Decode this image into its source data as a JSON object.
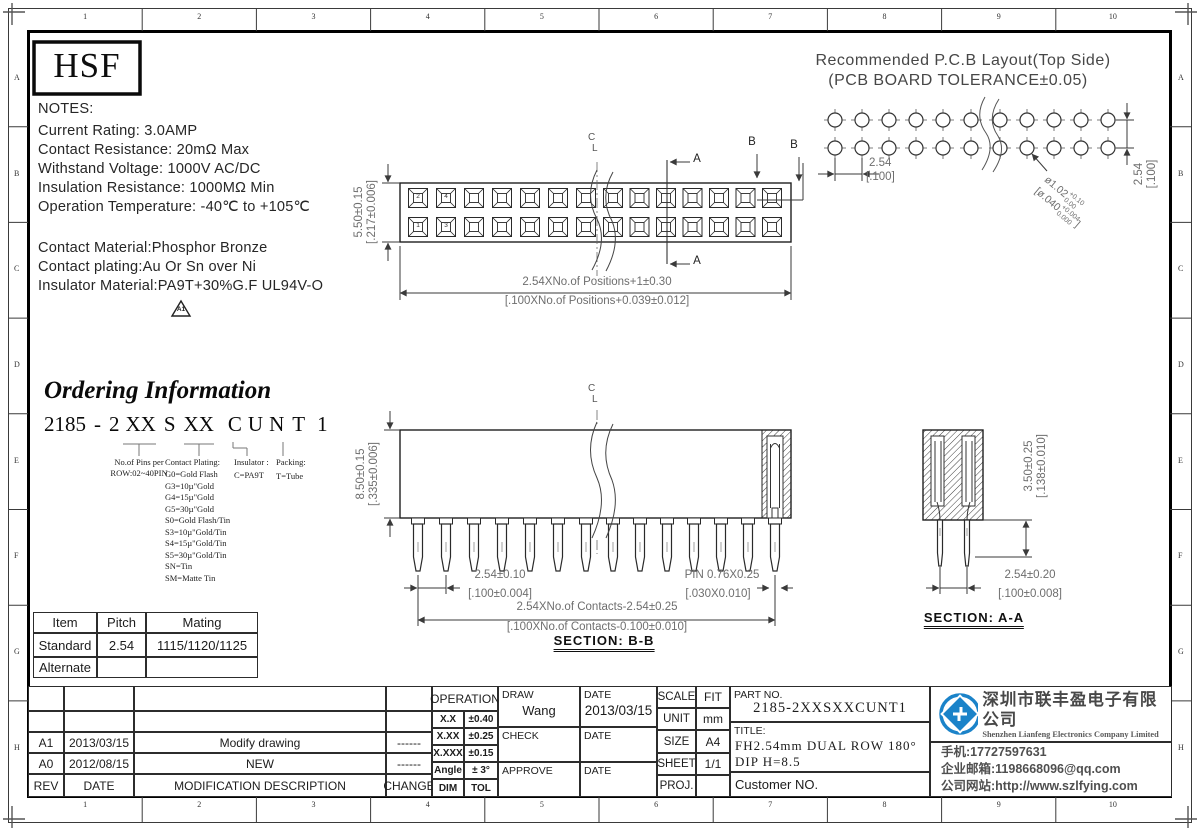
{
  "logo_text": "HSF",
  "zones": {
    "cols": [
      "1",
      "2",
      "3",
      "4",
      "5",
      "6",
      "7",
      "8",
      "9",
      "10"
    ],
    "rows": [
      "A",
      "B",
      "C",
      "D",
      "E",
      "F",
      "G",
      "H"
    ]
  },
  "notes": {
    "heading": "NOTES:",
    "lines": [
      "Current Rating: 3.0AMP",
      "Contact Resistance: 20mΩ Max",
      "Withstand Voltage: 1000V AC/DC",
      "Insulation Resistance: 1000MΩ Min",
      "Operation Temperature: -40℃ to +105℃"
    ],
    "material_lines": [
      "Contact Material:Phosphor Bronze",
      "Contact plating:Au Or Sn over Ni",
      "Insulator Material:PA9T+30%G.F UL94V-O"
    ],
    "rev_triangle": "A1"
  },
  "pcb_layout": {
    "title": "Recommended P.C.B Layout(Top Side)",
    "subtitle": "(PCB BOARD TOLERANCE±0.05)",
    "pitch": [
      "2.54",
      "[.100]"
    ],
    "row_pitch": [
      "2.54",
      "[.100]"
    ],
    "hole_mm": {
      "main": "ø1.02",
      "plus": "+0.10",
      "minus": "0.00"
    },
    "hole_in": {
      "main": "[ø.040",
      "plus": "+0.004",
      "minus": "0.000",
      "close": "]"
    }
  },
  "top_view": {
    "height_dim": [
      "5.50±0.15",
      "[.217±0.006]"
    ],
    "length_dim": [
      "2.54XNo.of Positions+1±0.30",
      "[.100XNo.of Positions+0.039±0.012]"
    ],
    "pin_labels": [
      "2",
      "4",
      "1",
      "3"
    ],
    "centerline": [
      "C",
      "L"
    ],
    "section_a": "A",
    "section_b": "B"
  },
  "section_bb": {
    "label": "SECTION: B-B",
    "centerline": [
      "C",
      "L"
    ],
    "height_dim": [
      "8.50±0.15",
      "[.335±0.006]"
    ],
    "pitch_dim": [
      "2.54±0.10",
      "[.100±0.004]"
    ],
    "pin_dim": [
      "PIN 0.76X0.25",
      "[.030X0.010]"
    ],
    "span_dim": [
      "2.54XNo.of Contacts-2.54±0.25",
      "[.100XNo.of Contacts-0.100±0.010]"
    ]
  },
  "section_aa": {
    "label": "SECTION: A-A",
    "tail_dim": [
      "3.50±0.25",
      "[.138±0.010]"
    ],
    "row_dim": [
      "2.54±0.20",
      "[.100±0.008]"
    ]
  },
  "ordering": {
    "title": "Ordering Information",
    "code_parts": [
      "2185",
      "-",
      "2",
      "XX",
      "S",
      "XX",
      "C",
      "U",
      "N",
      "T",
      "1"
    ],
    "pins_note": [
      "No.of Pins per",
      "ROW:02~40PIN"
    ],
    "plating_heading": "Contact Plating:",
    "plating_options": [
      "G0=Gold Flash",
      "G3=10µ\"Gold",
      "G4=15µ\"Gold",
      "G5=30µ\"Gold",
      "S0=Gold Flash/Tin",
      "S3=10µ\"Gold/Tin",
      "S4=15µ\"Gold/Tin",
      "S5=30µ\"Gold/Tin",
      "SN=Tin",
      "SM=Matte Tin"
    ],
    "insulator": [
      "Insulator :",
      "C=PA9T"
    ],
    "packing": [
      "Packing:",
      "T=Tube"
    ]
  },
  "mating_table": {
    "headers": [
      "Item",
      "Pitch",
      "Mating"
    ],
    "rows": [
      [
        "Standard",
        "2.54",
        "1115/1120/1125"
      ],
      [
        "Alternate",
        "",
        ""
      ]
    ]
  },
  "revision_table": {
    "headers": [
      "REV",
      "DATE",
      "MODIFICATION  DESCRIPTION",
      "CHANGE"
    ],
    "rows": [
      [
        "A1",
        "2013/03/15",
        "Modify  drawing",
        "------"
      ],
      [
        "A0",
        "2012/08/15",
        "NEW",
        "------"
      ]
    ]
  },
  "tolerance_table": {
    "heading": "OPERATION",
    "rows": [
      [
        "X.X",
        "±0.40"
      ],
      [
        "X.XX",
        "±0.25"
      ],
      [
        "X.XXX",
        "±0.15"
      ],
      [
        "Angle",
        "± 3°"
      ],
      [
        "DIM",
        "TOL"
      ]
    ]
  },
  "approval": {
    "draw_label": "DRAW",
    "draw_name": "Wang",
    "draw_date_label": "DATE",
    "draw_date": "2013/03/15",
    "check_label": "CHECK",
    "check_date_label": "DATE",
    "approve_label": "APPROVE",
    "approve_date_label": "DATE"
  },
  "info_table": {
    "rows": [
      [
        "SCALE",
        "FIT"
      ],
      [
        "UNIT",
        "mm"
      ],
      [
        "SIZE",
        "A4"
      ],
      [
        "SHEET",
        "1/1"
      ],
      [
        "PROJ.",
        ""
      ]
    ]
  },
  "part_block": {
    "part_no_label": "PART NO.",
    "part_no": "2185-2XXSXXCUNT1",
    "title_label": "TITLE:",
    "title": "FH2.54mm DUAL ROW 180° DIP H=8.5",
    "customer_label": "Customer NO."
  },
  "company": {
    "brand_color": "#1b83c9",
    "name_cn": "深圳市联丰盈电子有限公司",
    "name_en": "Shenzhen Lianfeng Electronics Company Limited",
    "phone": "手机:17727597631",
    "email": "企业邮箱:1198668096@qq.com",
    "website": "公司网站:http://www.szlfying.com"
  }
}
